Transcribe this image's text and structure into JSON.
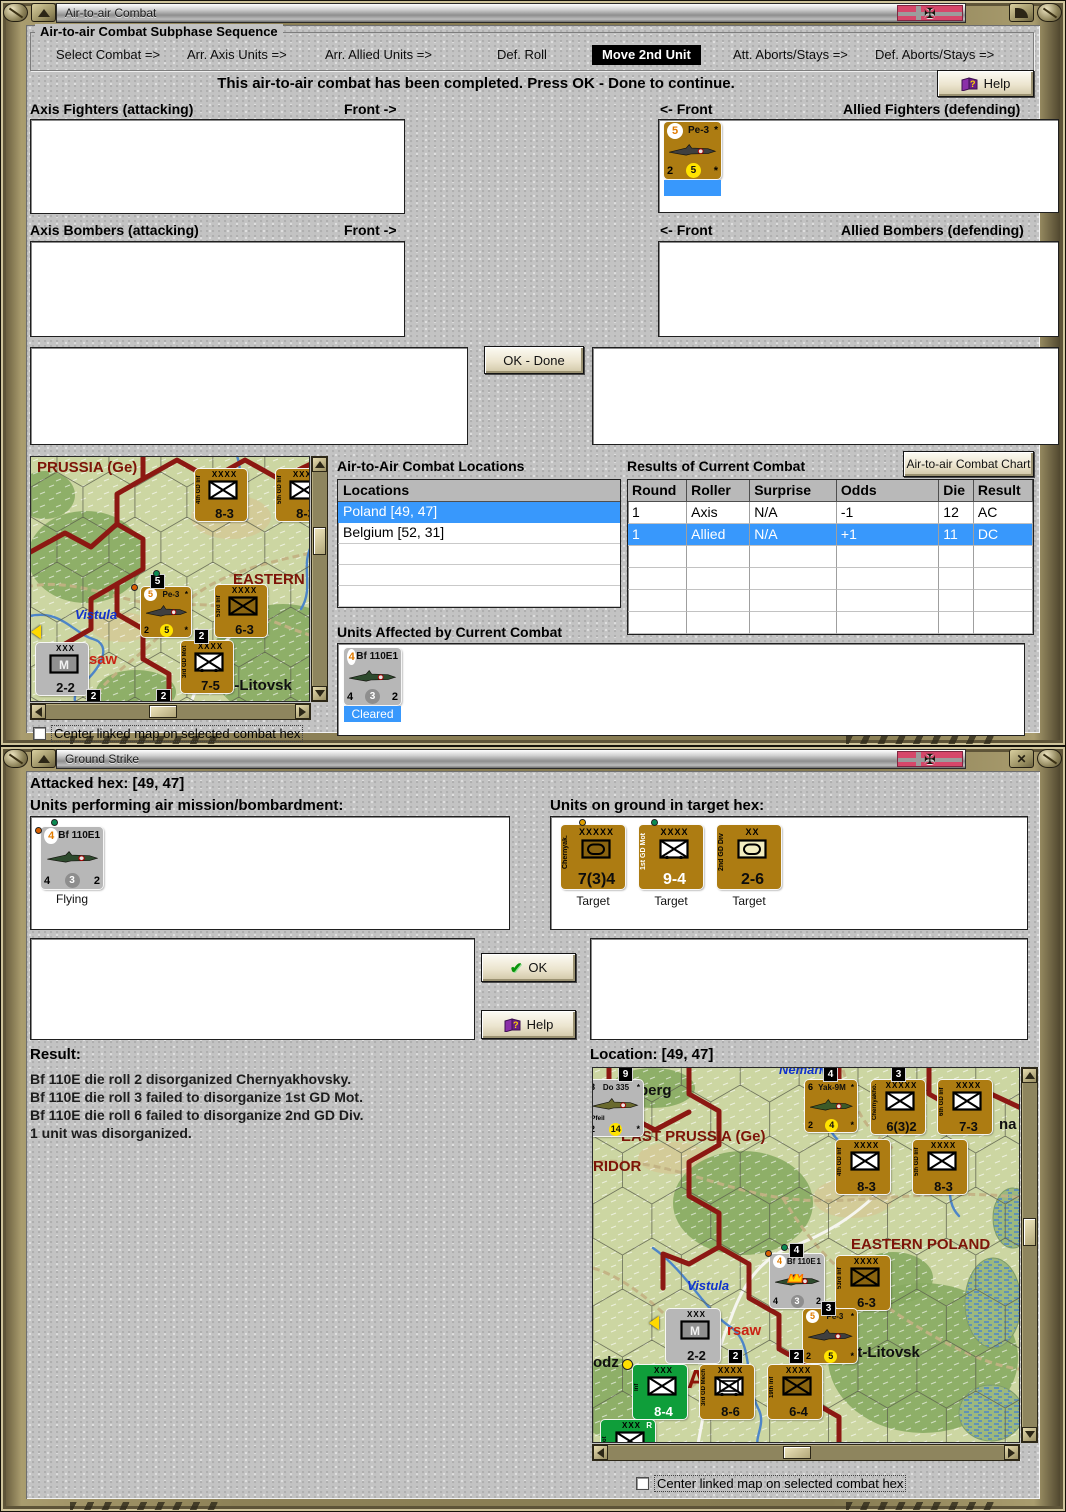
{
  "win_air": {
    "title": "Air-to-air Combat",
    "group_title": "Air-to-air Combat Subphase Sequence",
    "sequence": [
      {
        "label": "Select Combat =>",
        "active": false
      },
      {
        "label": "Arr. Axis Units =>",
        "active": false
      },
      {
        "label": "Arr. Allied Units =>",
        "active": false
      },
      {
        "label": "Def. Roll",
        "active": false
      },
      {
        "label": "Move 2nd Unit",
        "active": true
      },
      {
        "label": "Att. Aborts/Stays =>",
        "active": false
      },
      {
        "label": "Def. Aborts/Stays =>",
        "active": false
      }
    ],
    "message": "This air-to-air combat has been completed.  Press OK - Done to continue.",
    "help_label": "Help",
    "labels": {
      "axis_fighters": "Axis Fighters (attacking)",
      "front_right": "Front ->",
      "front_left": "<- Front",
      "allied_fighters": "Allied Fighters (defending)",
      "axis_bombers": "Axis Bombers (attacking)",
      "allied_bombers": "Allied Bombers (defending)"
    },
    "ok_done": "OK - Done",
    "locations_title": "Air-to-Air Combat Locations",
    "locations_header": "Locations",
    "locations": [
      {
        "label": "Poland [49, 47]",
        "selected": true
      },
      {
        "label": "Belgium [52, 31]",
        "selected": false
      }
    ],
    "results_title": "Results of Current Combat",
    "chart_button": "Air-to-air Combat Chart",
    "results": {
      "columns": [
        "Round",
        "Roller",
        "Surprise",
        "Odds",
        "Die",
        "Result"
      ],
      "rows": [
        {
          "cells": [
            "1",
            "Axis",
            "N/A",
            "-1",
            "12",
            "AC"
          ],
          "selected": false
        },
        {
          "cells": [
            "1",
            "Allied",
            "N/A",
            "+1",
            "11",
            "DC"
          ],
          "selected": true
        }
      ]
    },
    "units_affected_title": "Units Affected by Current Combat",
    "allied_fighter_unit": {
      "kind": "air",
      "color": "brown",
      "tl": "5",
      "tl_circle": true,
      "title": "Pe-3",
      "tr": "*",
      "bl": "2",
      "bc": "5",
      "bc_style": "yellow",
      "br": "*",
      "plane": "#3f3f3f",
      "status": "",
      "status_sel": true
    },
    "affected_unit": {
      "kind": "air",
      "color": "gray",
      "tl": "4",
      "tl_circle": true,
      "title": "Bf 110E",
      "tr": "1",
      "bl": "4",
      "bc": "3",
      "bc_style": "gray",
      "br": "2",
      "plane": "#2e4b2e",
      "status": "Cleared",
      "status_sel": true
    },
    "center_checkbox": "Center linked map on selected combat hex"
  },
  "win_ground": {
    "title": "Ground Strike",
    "attacked_hex": "Attacked hex:  [49, 47]",
    "mission_title": "Units performing air mission/bombardment:",
    "ground_title": "Units on ground in target hex:",
    "mission_unit": {
      "kind": "air",
      "color": "gray",
      "tl": "4",
      "tl_circle": true,
      "title": "Bf 110E",
      "tr": "1",
      "bl": "4",
      "bc": "3",
      "bc_style": "gray",
      "br": "2",
      "plane": "#2e4b2e",
      "status": "Flying",
      "status_sel": false
    },
    "ground_units": [
      {
        "kind": "ground",
        "color": "brown",
        "size": "XXXXX",
        "name": "Chernyak.",
        "symbol": "hq-dark",
        "value": "7(3)4",
        "status": "Target"
      },
      {
        "kind": "ground",
        "color": "brown",
        "size": "XXXX",
        "name": "1st GD Mot",
        "name_light": true,
        "symbol": "mot",
        "value": "9-4",
        "value_light": true,
        "status": "Target"
      },
      {
        "kind": "ground",
        "color": "brown",
        "size": "XX",
        "name": "2nd GD Div",
        "symbol": "armor",
        "value": "2-6",
        "status": "Target"
      }
    ],
    "ok_label": "OK",
    "help_label": "Help",
    "result_title": "Result:",
    "result_lines": [
      "Bf 110E die roll 2 disorganized Chernyakhovsky.",
      "Bf 110E die roll 3 failed to disorganize 1st GD Mot.",
      "Bf 110E die roll 6 failed to disorganize 2nd GD Div.",
      "1 unit was disorganized."
    ],
    "location_label": "Location:  [49, 47]",
    "center_checkbox": "Center linked map on selected combat hex"
  },
  "map_top": {
    "labels": [
      {
        "t": "PRUSSIA (Ge)",
        "x": 6,
        "y": 2,
        "c": "region"
      },
      {
        "t": "EASTERN P",
        "x": 202,
        "y": 114,
        "c": "region"
      },
      {
        "t": "Vistula",
        "x": 44,
        "y": 150,
        "c": "water"
      },
      {
        "t": "rsaw",
        "x": 52,
        "y": 194,
        "c": "cityred"
      },
      {
        "t": "st-Litovsk",
        "x": 190,
        "y": 220,
        "c": "city"
      }
    ],
    "units": [
      {
        "kind": "ground",
        "color": "brown",
        "size": "XXXX",
        "name": "4th GD Inf",
        "symbol": "inf",
        "value": "8-3",
        "x": 164,
        "y": 12,
        "w": 52
      },
      {
        "kind": "ground",
        "color": "brown",
        "size": "XXXX",
        "name": "5th GD Inf",
        "symbol": "inf",
        "value": "8-3",
        "x": 245,
        "y": 12,
        "w": 52
      },
      {
        "kind": "air",
        "color": "brown",
        "tl": "5",
        "tl_circle": true,
        "title": "Pe-3",
        "tr": "*",
        "bl": "2",
        "bc": "5",
        "bc_style": "yellow",
        "br": "*",
        "plane": "#3f3f3f",
        "x": 110,
        "y": 130,
        "w": 50
      },
      {
        "kind": "ground",
        "color": "brown",
        "size": "XXXX",
        "name": "53rd Inf",
        "symbol": "inf-dark",
        "value": "6-3",
        "x": 184,
        "y": 128,
        "w": 52
      },
      {
        "kind": "ground",
        "color": "gray",
        "size": "XXX",
        "name": "",
        "symbol": "m",
        "value": "2-2",
        "x": 5,
        "y": 186,
        "w": 52
      },
      {
        "kind": "ground",
        "color": "brown",
        "size": "XXXX",
        "name": "3rd GD Mot",
        "symbol": "mot",
        "value": "7-5",
        "x": 150,
        "y": 184,
        "w": 52
      }
    ],
    "badges": [
      {
        "t": "5",
        "x": 120,
        "y": 118
      },
      {
        "t": "2",
        "x": 164,
        "y": 173
      },
      {
        "t": "2",
        "x": 56,
        "y": 233
      },
      {
        "t": "2",
        "x": 126,
        "y": 233
      }
    ],
    "dots": [
      {
        "x": 122,
        "y": 113,
        "c": "#0a8a52"
      },
      {
        "x": 100,
        "y": 127,
        "c": "#d85f00"
      }
    ],
    "chevs": [
      {
        "x": 0,
        "y": 168
      }
    ]
  },
  "map_bottom": {
    "labels": [
      {
        "t": "K",
        "x": 2,
        "y": 14,
        "c": "city"
      },
      {
        "t": "berg",
        "x": 46,
        "y": 14,
        "c": "city"
      },
      {
        "t": "Neman",
        "x": 186,
        "y": -6,
        "c": "water"
      },
      {
        "t": "EAST PRUSSIA (Ge)",
        "x": 28,
        "y": 60,
        "c": "region"
      },
      {
        "t": "RIDOR",
        "x": 0,
        "y": 90,
        "c": "region"
      },
      {
        "t": "na",
        "x": 406,
        "y": 48,
        "c": "city"
      },
      {
        "t": "EASTERN POLAND",
        "x": 258,
        "y": 168,
        "c": "region"
      },
      {
        "t": "Vistula",
        "x": 94,
        "y": 210,
        "c": "water"
      },
      {
        "t": "rsaw",
        "x": 134,
        "y": 254,
        "c": "cityred"
      },
      {
        "t": "odz",
        "x": 0,
        "y": 286,
        "c": "city"
      },
      {
        "t": "st-Litovsk",
        "x": 256,
        "y": 276,
        "c": "city"
      },
      {
        "t": "I",
        "x": 52,
        "y": 294,
        "c": "regionbig"
      },
      {
        "t": "A",
        "x": 94,
        "y": 296,
        "c": "regionbig"
      }
    ],
    "units": [
      {
        "kind": "air",
        "color": "gray",
        "tl": "8",
        "tl_circle": false,
        "title": "Do 335",
        "tr": "*",
        "sub": "Pfeil",
        "bl": "2",
        "bc": "14",
        "bc_style": "yellow",
        "br": "*",
        "plane": "#6a6a2e",
        "x": -6,
        "y": 12,
        "w": 56
      },
      {
        "kind": "air",
        "color": "brown",
        "tl": "6",
        "tl_circle": false,
        "title": "Yak-9M",
        "tr": "*",
        "bl": "2",
        "bc": "4",
        "bc_style": "yellow",
        "br": "*",
        "plane": "#3c5a28",
        "x": 212,
        "y": 12,
        "w": 52
      },
      {
        "kind": "ground",
        "color": "brown",
        "size": "XXXXX",
        "name": "Chernyakho.",
        "symbol": "inf",
        "value": "6(3)2",
        "x": 278,
        "y": 12,
        "w": 54
      },
      {
        "kind": "ground",
        "color": "brown",
        "size": "XXXX",
        "name": "6th GD Inf",
        "symbol": "inf",
        "value": "7-3",
        "x": 345,
        "y": 12,
        "w": 54
      },
      {
        "kind": "ground",
        "color": "brown",
        "size": "XXXX",
        "name": "4th GD Inf",
        "symbol": "inf",
        "value": "8-3",
        "x": 243,
        "y": 72,
        "w": 54
      },
      {
        "kind": "ground",
        "color": "brown",
        "size": "XXXX",
        "name": "5th GD Inf",
        "symbol": "inf",
        "value": "8-3",
        "x": 320,
        "y": 72,
        "w": 54
      },
      {
        "kind": "air",
        "color": "gray",
        "tl": "4",
        "tl_circle": true,
        "title": "Bf 110E",
        "tr": "1",
        "bl": "4",
        "bc": "3",
        "bc_style": "gray",
        "br": "2",
        "plane": "#2e4b2e",
        "burning": true,
        "x": 177,
        "y": 186,
        "w": 54
      },
      {
        "kind": "ground",
        "color": "brown",
        "size": "XXXX",
        "name": "53rd Inf",
        "symbol": "inf-dark",
        "value": "6-3",
        "x": 243,
        "y": 188,
        "w": 54
      },
      {
        "kind": "air",
        "color": "brown",
        "tl": "5",
        "tl_circle": true,
        "title": "Pe-3",
        "tr": "*",
        "bl": "2",
        "bc": "5",
        "bc_style": "yellow",
        "br": "*",
        "plane": "#3f3f3f",
        "x": 210,
        "y": 241,
        "w": 54
      },
      {
        "kind": "ground",
        "color": "gray",
        "size": "XXX",
        "name": "",
        "symbol": "m",
        "value": "2-2",
        "x": 73,
        "y": 241,
        "w": 54
      },
      {
        "kind": "ground",
        "color": "green",
        "size": "XXX",
        "name": "Inf",
        "symbol": "inf",
        "value": "8-4",
        "value_light": true,
        "x": 40,
        "y": 297,
        "w": 54
      },
      {
        "kind": "ground",
        "color": "brown",
        "size": "XXXX",
        "name": "3rd GD Mech",
        "symbol": "mech",
        "value": "8-6",
        "x": 107,
        "y": 297,
        "w": 54
      },
      {
        "kind": "ground",
        "color": "brown",
        "size": "XXXX",
        "name": "19th Inf",
        "symbol": "inf-dark",
        "value": "6-4",
        "x": 175,
        "y": 297,
        "w": 54
      },
      {
        "kind": "ground",
        "color": "green",
        "size": "XXX",
        "tr": "R",
        "name": "Mot",
        "symbol": "inf",
        "value": "8-4",
        "value_light": true,
        "x": 8,
        "y": 352,
        "w": 54
      }
    ],
    "badges": [
      {
        "t": "9",
        "x": 26,
        "y": 0
      },
      {
        "t": "4",
        "x": 231,
        "y": 0
      },
      {
        "t": "3",
        "x": 299,
        "y": 0
      },
      {
        "t": "4",
        "x": 197,
        "y": 176
      },
      {
        "t": "3",
        "x": 229,
        "y": 234
      },
      {
        "t": "2",
        "x": 136,
        "y": 282
      },
      {
        "t": "2",
        "x": 197,
        "y": 282
      }
    ],
    "dots": [
      {
        "x": 172,
        "y": 182,
        "c": "#d85f00"
      },
      {
        "x": 188,
        "y": 176,
        "c": "#0a8a52"
      },
      {
        "x": 29,
        "y": 291,
        "c": "#ffe000",
        "big": true
      }
    ],
    "chevs": [
      {
        "x": 56,
        "y": 248
      }
    ]
  }
}
